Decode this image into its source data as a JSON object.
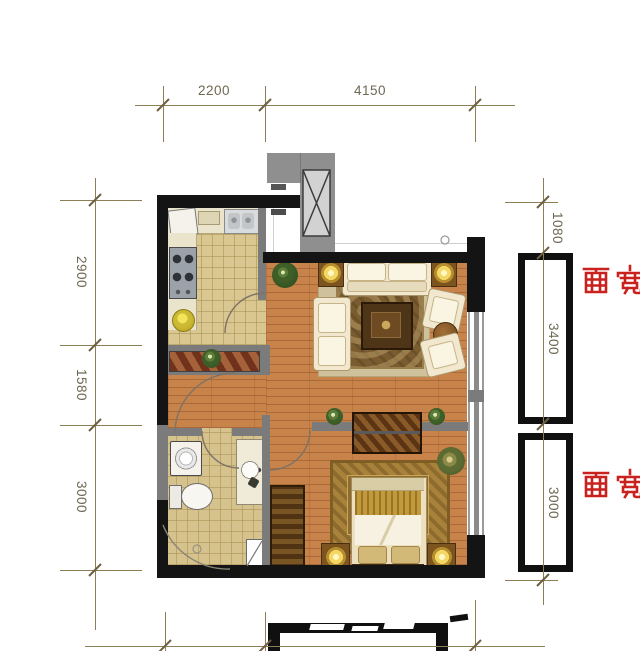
{
  "title": "apartment-floor-plan",
  "dims": {
    "top": [
      "2200",
      "4150"
    ],
    "left": [
      "2900",
      "1580",
      "3000"
    ],
    "right_top": "1080",
    "right_bays": [
      "3400",
      "3000"
    ],
    "bay_label": "面宽"
  },
  "colors": {
    "dimension_line": "#8d7f55",
    "dimension_text": "#6e6852",
    "bay_label_red": "#c9211e",
    "wall_black": "#141414",
    "partition_gray": "#7b7b7b",
    "shaft_gray": "#8f8f8f",
    "wood_floor": "#c8834b",
    "tile_floor": "#d9c691"
  },
  "elements": {
    "rooms": [
      "kitchen",
      "hallway",
      "living-room",
      "bathroom",
      "bedroom",
      "elevator-shaft"
    ],
    "furniture": [
      "refrigerator",
      "kitchen-sink",
      "stove",
      "kitchen-counter",
      "shoe-cabinet",
      "washing-machine",
      "toilet",
      "bathroom-vanity",
      "shower",
      "sofa",
      "armchairs",
      "coffee-table",
      "side-tables-with-lamps",
      "tv-cabinet",
      "double-bed",
      "nightstands",
      "wardrobe",
      "area-rugs",
      "plants"
    ],
    "architecture": [
      "bay-windows",
      "windows",
      "door-swings",
      "elevator"
    ]
  }
}
